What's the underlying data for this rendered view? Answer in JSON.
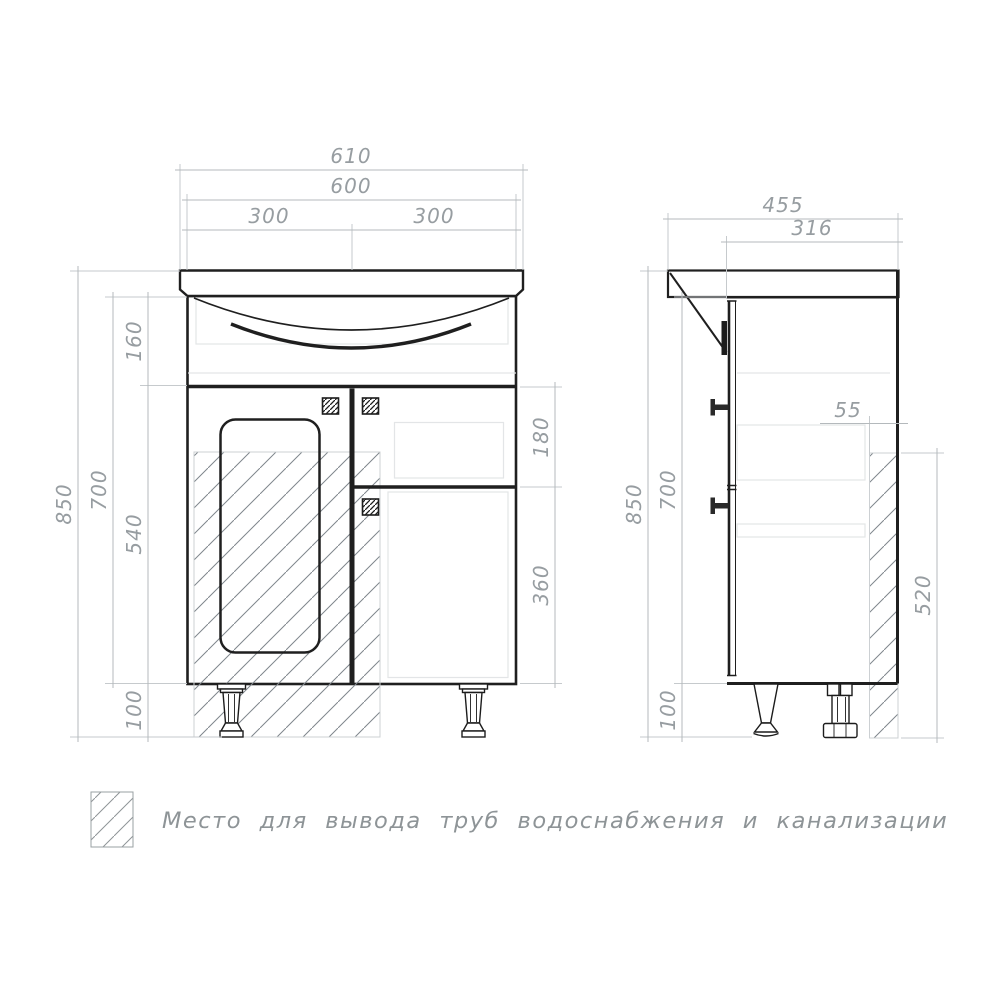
{
  "drawing_title": "vanity-cabinet-dimension-drawing",
  "front_view": {
    "dims_top": {
      "overall_width": "610",
      "cabinet_width": "600",
      "left_half_width": "300",
      "right_half_width": "300"
    },
    "dims_left": {
      "overall_height": "850",
      "cabinet_body_height": "700",
      "sink_section_height": "160",
      "door_section_height": "540",
      "legs_height": "100"
    },
    "dims_right": {
      "drawer_section_height": "180",
      "lower_door_height": "360"
    }
  },
  "side_view": {
    "dims_top": {
      "overall_depth": "455",
      "cabinet_depth": "316"
    },
    "dims_left": {
      "overall_height": "850",
      "cabinet_body_height": "700",
      "legs_height": "100"
    },
    "dims_right": {
      "pipe_zone_width": "55",
      "pipe_zone_height": "520"
    }
  },
  "legend": {
    "label": "Место для вывода труб водоснабжения и канализации"
  },
  "colors": {
    "main_line": "#1f1f1f",
    "dimension_line": "#b4b9bc",
    "dimension_text": "#979da1",
    "construction_line": "#e3e5e7",
    "hatch_line": "#7f868c",
    "background": "#ffffff"
  }
}
